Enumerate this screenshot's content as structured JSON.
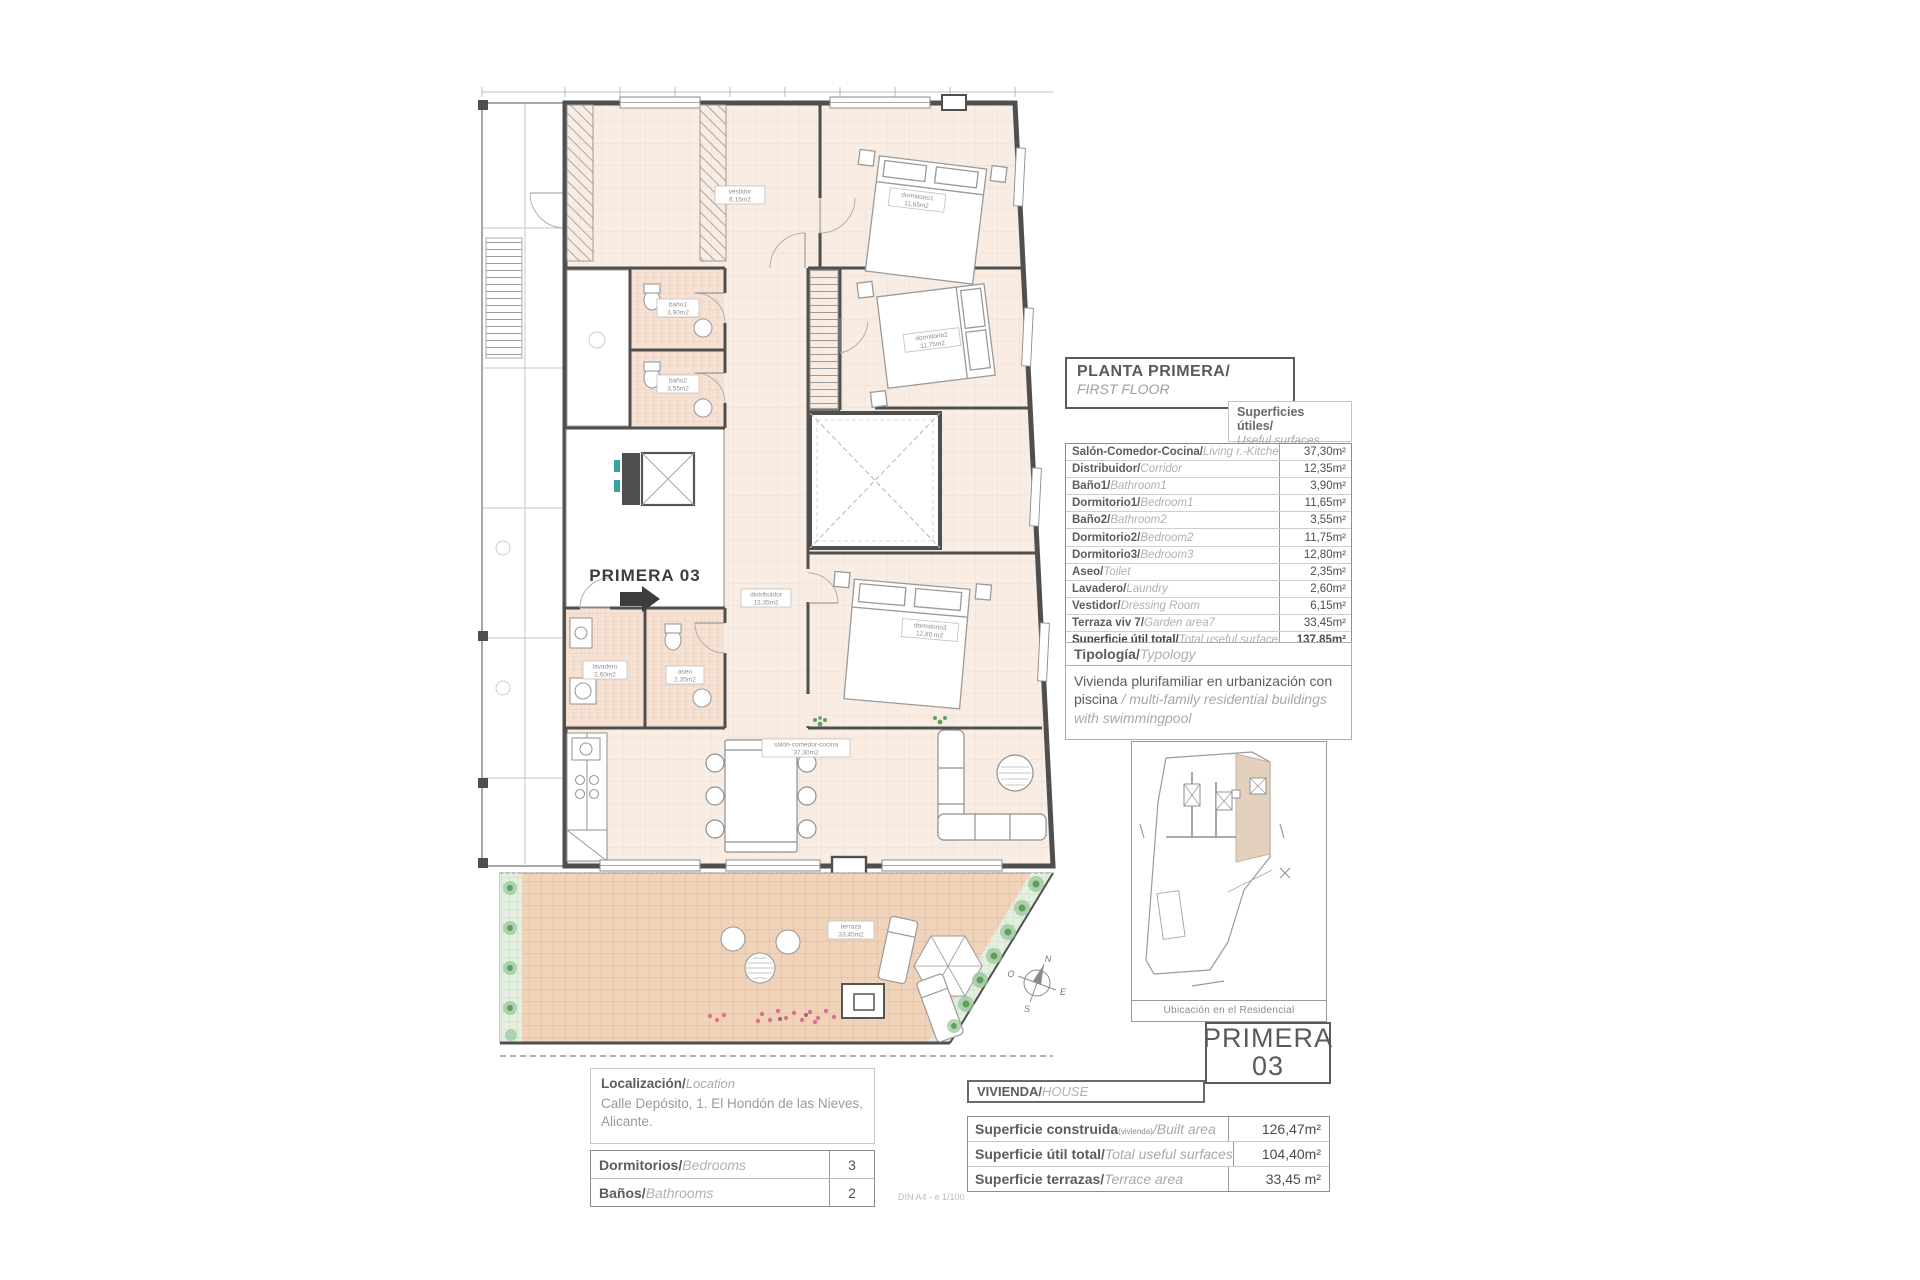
{
  "header": {
    "title": "PLANTA PRIMERA/",
    "subtitle": "FIRST FLOOR"
  },
  "surfaces": {
    "caption": "Superficies útiles/",
    "caption_en": "Useful surfaces",
    "rows": [
      {
        "label": "Salón-Comedor-Cocina/",
        "label_en": "Living r.-Kitchen",
        "value": "37,30m²"
      },
      {
        "label": "Distribuidor/",
        "label_en": "Corridor",
        "value": "12,35m²"
      },
      {
        "label": "Baño1/",
        "label_en": "Bathroom1",
        "value": "3,90m²"
      },
      {
        "label": "Dormitorio1/",
        "label_en": "Bedroom1",
        "value": "11,65m²"
      },
      {
        "label": "Baño2/",
        "label_en": "Bathroom2",
        "value": "3,55m²"
      },
      {
        "label": "Dormitorio2/",
        "label_en": "Bedroom2",
        "value": "11,75m²"
      },
      {
        "label": "Dormitorio3/",
        "label_en": "Bedroom3",
        "value": "12,80m²"
      },
      {
        "label": "Aseo/",
        "label_en": "Toilet",
        "value": "2,35m²"
      },
      {
        "label": "Lavadero/",
        "label_en": "Laundry",
        "value": "2,60m²"
      },
      {
        "label": "Vestidor/",
        "label_en": "Dressing Room",
        "value": "6,15m²"
      },
      {
        "label": "Terraza viv 7/",
        "label_en": "Garden area7",
        "value": "33,45m²"
      },
      {
        "label": "Superficie útil total/",
        "label_en": "Total useful surface",
        "value": "137,85m²"
      }
    ]
  },
  "typology": {
    "heading": "Tipología/",
    "heading_en": "Typology",
    "text": "Vivienda plurifamiliar en urbanización con piscina ",
    "text_en": "/ multi-family residential buildings with swimmingpool"
  },
  "site_map": {
    "caption": "Ubicación en el Residencial"
  },
  "unit_badge": {
    "line1": "PRIMERA",
    "line2": "03"
  },
  "location": {
    "heading": "Localización/",
    "heading_en": "Location",
    "address": "Calle Depósito, 1. El Hondón de las Nieves, Alicante."
  },
  "counts": {
    "rows": [
      {
        "label": "Dormitorios/",
        "label_en": "Bedrooms",
        "value": "3"
      },
      {
        "label": "Baños/",
        "label_en": "Bathrooms",
        "value": "2"
      }
    ]
  },
  "vivienda": {
    "heading": "VIVIENDA/",
    "heading_en": "HOUSE",
    "rows": [
      {
        "label": "Superficie construida",
        "label_note": "(vivienda)",
        "label_en": "/Built area",
        "value": "126,47m²"
      },
      {
        "label": "Superficie útil total/",
        "label_note": "",
        "label_en": "Total useful surfaces",
        "value": "104,40m²"
      },
      {
        "label": "Superficie terrazas/",
        "label_note": "",
        "label_en": "Terrace area",
        "value": "33,45 m²"
      }
    ]
  },
  "plan": {
    "unit_label": "PRIMERA 03",
    "rooms": {
      "vestidor": {
        "name": "vestidor",
        "area": "6,15m2"
      },
      "dormitorio1": {
        "name": "dormitorio1",
        "area": "11,65m2"
      },
      "banio1": {
        "name": "baño1",
        "area": "3,90m2"
      },
      "banio2": {
        "name": "baño2",
        "area": "3,55m2"
      },
      "dormitorio2": {
        "name": "dormitorio2",
        "area": "11,75m2"
      },
      "dormitorio3": {
        "name": "dormitorio3",
        "area": "12,80 m2"
      },
      "distribuidor": {
        "name": "distribuidor",
        "area": "12,35m2"
      },
      "aseo": {
        "name": "aseo",
        "area": "2,35m2"
      },
      "lavadero": {
        "name": "lavadero",
        "area": "2,60m2"
      },
      "salon": {
        "name": "salón-comedor-cocina",
        "area": "37,30m2"
      },
      "terraza": {
        "name": "terraza",
        "area": "33,45m2"
      }
    },
    "compass": {
      "n": "N",
      "s": "S",
      "e": "E",
      "w": "O"
    }
  },
  "footer": {
    "scale_note": "DIN A4 - e 1/100"
  },
  "colors": {
    "accent_floor": "#f9ece3",
    "accent_terrace": "#f1d3b9",
    "wall": "#4f4f4f"
  }
}
